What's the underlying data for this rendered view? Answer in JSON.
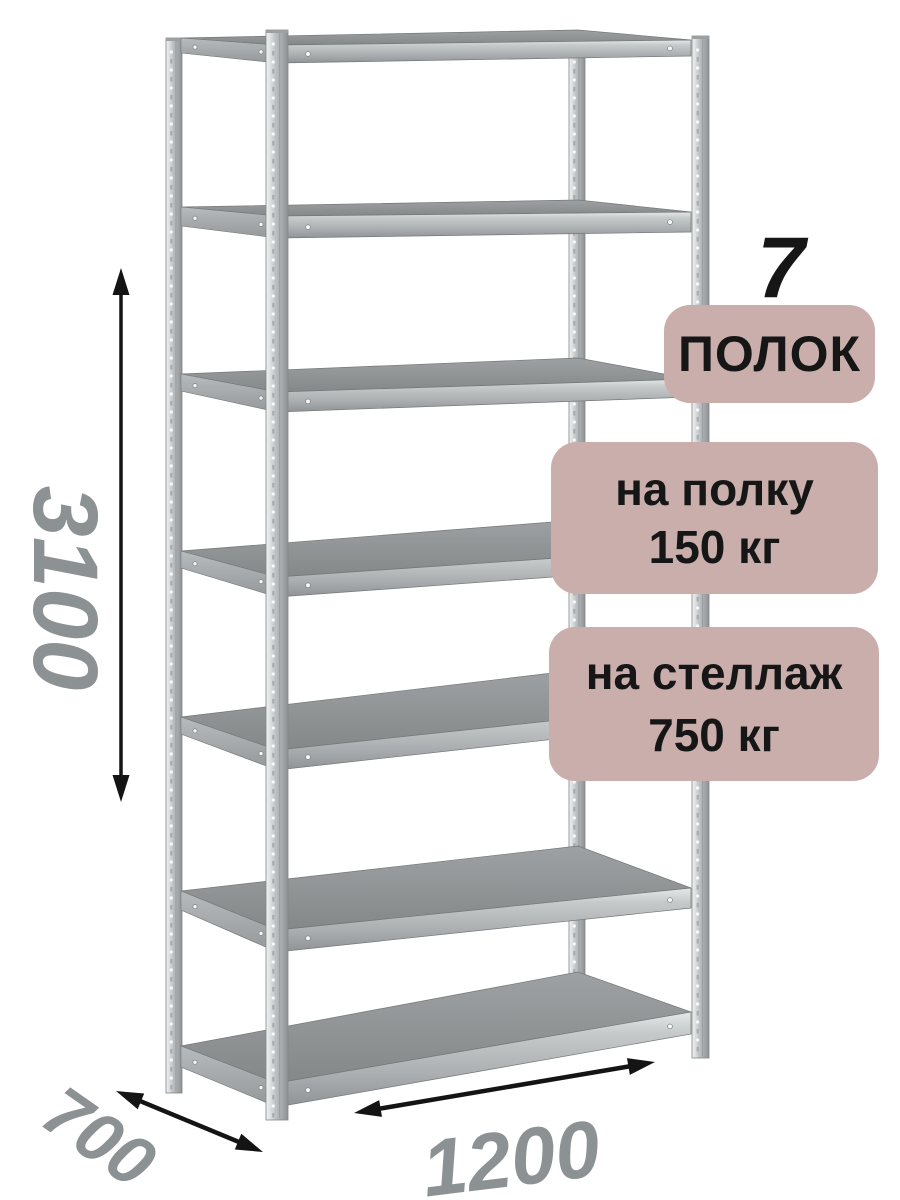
{
  "badges": {
    "shelf_count_number": "7",
    "shelf_count_label": "ПОЛОК",
    "per_shelf": {
      "line1": "на полку",
      "line2": "150 кг"
    },
    "per_rack": {
      "line1": "на стеллаж",
      "line2": "750 кг"
    }
  },
  "dimensions": {
    "height": "3100",
    "depth": "700",
    "width": "1200"
  },
  "illustration": {
    "name": "metal-shelving-rack",
    "shelf_count": 7
  },
  "colors": {
    "background": "#ffffff",
    "badge_bg": "#c9aeab",
    "text_dark": "#161616",
    "dimension_text": "#8c9193",
    "arrow": "#141414",
    "metal_light": "#eef0f0",
    "metal_mid": "#b5b9bb",
    "metal_dark": "#8a8e90",
    "shelf_top_dark": "#848889"
  }
}
